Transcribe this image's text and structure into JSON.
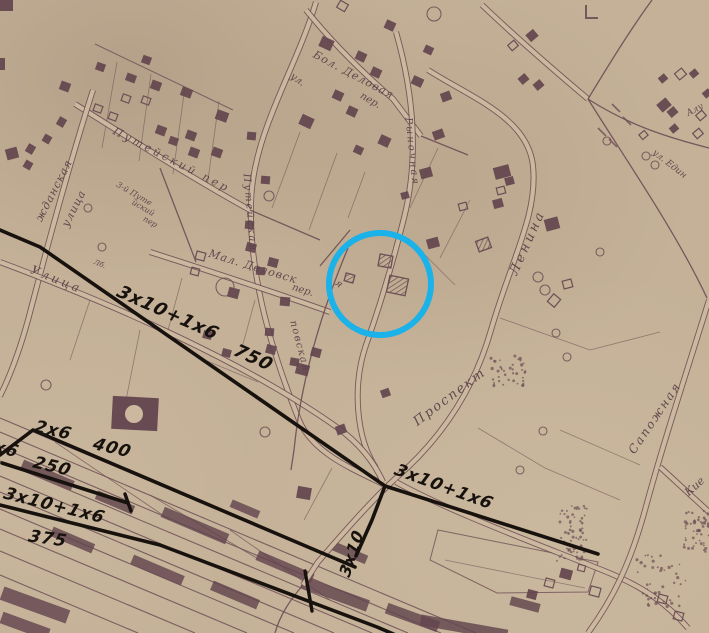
{
  "map_title": "scanned town plan with electrical line annotations",
  "colors": {
    "paper": "#c4b197",
    "paper_light": "#cbb89e",
    "ink": "#6e4e55",
    "ink_dark": "#5a3f48",
    "building": "#63454e",
    "black": "#17120e",
    "blue": "#1ab2e8"
  },
  "highlight_circle": {
    "cx": 380,
    "cy": 284,
    "r": 51,
    "stroke_width": 6
  },
  "street_labels": [
    {
      "t": "жданская",
      "x": 57,
      "y": 192,
      "r": -63,
      "s": 11,
      "sp": 1
    },
    {
      "t": "улица",
      "x": 77,
      "y": 210,
      "r": -63,
      "s": 11,
      "sp": 1
    },
    {
      "t": "Путейский пер",
      "x": 170,
      "y": 163,
      "r": 27,
      "s": 11,
      "sp": 3
    },
    {
      "t": "3-й Путе",
      "x": 133,
      "y": 196,
      "r": 30,
      "s": 8,
      "sp": 0
    },
    {
      "t": "йский",
      "x": 142,
      "y": 210,
      "r": 30,
      "s": 8,
      "sp": 0
    },
    {
      "t": "пер",
      "x": 149,
      "y": 224,
      "r": 30,
      "s": 8,
      "sp": 0
    },
    {
      "t": "Путейская",
      "x": 247,
      "y": 213,
      "r": 85,
      "s": 10,
      "sp": 2
    },
    {
      "t": "ул.",
      "x": 296,
      "y": 82,
      "r": 35,
      "s": 10,
      "sp": 0
    },
    {
      "t": "Бол. Деловая",
      "x": 352,
      "y": 78,
      "r": 28,
      "s": 11,
      "sp": 1
    },
    {
      "t": "пер.",
      "x": 369,
      "y": 103,
      "r": 30,
      "s": 10,
      "sp": 0
    },
    {
      "t": "Рыночная",
      "x": 409,
      "y": 152,
      "r": 84,
      "s": 10,
      "sp": 2
    },
    {
      "t": "Мал. Деловск",
      "x": 252,
      "y": 270,
      "r": 17,
      "s": 11,
      "sp": 1
    },
    {
      "t": "пер.",
      "x": 302,
      "y": 293,
      "r": 17,
      "s": 10,
      "sp": 0
    },
    {
      "t": "повская",
      "x": 297,
      "y": 347,
      "r": 75,
      "s": 10,
      "sp": 1.5
    },
    {
      "t": "я",
      "x": 337,
      "y": 286,
      "r": 40,
      "s": 10,
      "sp": 0
    },
    {
      "t": "Ленина",
      "x": 531,
      "y": 244,
      "r": -66,
      "s": 13,
      "sp": 3
    },
    {
      "t": "Проспект",
      "x": 452,
      "y": 400,
      "r": -37,
      "s": 13,
      "sp": 2
    },
    {
      "t": "Сапожная",
      "x": 658,
      "y": 420,
      "r": -56,
      "s": 12,
      "sp": 2
    },
    {
      "t": "Кие",
      "x": 697,
      "y": 489,
      "r": -42,
      "s": 11,
      "sp": 0
    },
    {
      "t": "Алу",
      "x": 696,
      "y": 112,
      "r": -28,
      "s": 9,
      "sp": 0
    },
    {
      "t": "ул. Един",
      "x": 668,
      "y": 166,
      "r": 38,
      "s": 9,
      "sp": 0
    },
    {
      "t": "Улица",
      "x": 55,
      "y": 283,
      "r": 22,
      "s": 12,
      "sp": 3
    },
    {
      "t": "Лб.",
      "x": 99,
      "y": 266,
      "r": 22,
      "s": 7,
      "sp": 0
    }
  ],
  "spec_annotations": [
    {
      "t": "3х10+1х6",
      "x": 197,
      "y": 332,
      "r": 24,
      "s": 18
    },
    {
      "t": "750",
      "x": 287,
      "y": 379,
      "r": 24,
      "s": 18
    },
    {
      "t": "2х6",
      "x": 97,
      "y": 446,
      "r": 13,
      "s": 17
    },
    {
      "t": "400",
      "x": 158,
      "y": 464,
      "r": 13,
      "s": 17
    },
    {
      "t": "2х6",
      "x": 46,
      "y": 464,
      "r": 13,
      "s": 17
    },
    {
      "t": "250",
      "x": 100,
      "y": 483,
      "r": 13,
      "s": 17
    },
    {
      "t": "3х10+1х6",
      "x": 106,
      "y": 524,
      "r": 14,
      "s": 17
    },
    {
      "t": "375",
      "x": 104,
      "y": 552,
      "r": 8,
      "s": 17
    },
    {
      "t": "3х10",
      "x": 373,
      "y": 505,
      "r": -72,
      "s": 16
    },
    {
      "t": "3х10+1х6",
      "x": 492,
      "y": 510,
      "r": 20,
      "s": 17
    }
  ],
  "power_lines": [
    [
      [
        0,
        230
      ],
      [
        40,
        247
      ],
      [
        385,
        486
      ]
    ],
    [
      [
        385,
        486
      ],
      [
        598,
        554
      ]
    ],
    [
      [
        385,
        486
      ],
      [
        372,
        520
      ],
      [
        356,
        556
      ]
    ],
    [
      [
        0,
        455
      ],
      [
        33,
        430
      ],
      [
        355,
        567
      ]
    ],
    [
      [
        2,
        463
      ],
      [
        128,
        503
      ]
    ],
    [
      [
        0,
        505
      ],
      [
        160,
        545
      ],
      [
        377,
        627
      ],
      [
        405,
        639
      ]
    ]
  ],
  "power_ticks": [
    [
      125,
      494,
      131,
      511
    ],
    [
      305,
      571,
      312,
      611
    ]
  ],
  "roads_double": [
    "M 428,70 C 472,98 528,118 533,166 C 538,214 512,258 491,330 C 471,400 433,446 396,478 C 372,500 344,532 318,562 L 303,585",
    "M 396,482 C 450,512 540,545 602,570 C 645,587 668,605 688,628",
    "M 709,300 C 688,368 664,440 645,510 C 630,565 612,600 588,633",
    "M 660,467 L 709,512",
    "M 316,2 C 296,70 253,132 251,202 C 249,268 267,340 299,420 C 312,452 350,468 383,484",
    "M 306,10 C 330,40 362,72 393,99 L 421,136",
    "M 396,32 C 414,95 419,158 404,218 C 394,258 382,300 366,345 C 352,386 356,438 376,468",
    "M 75,104 C 132,140 192,178 250,210",
    "M 93,90 C 70,162 49,240 28,320 C 18,356 8,380 0,396",
    "M 0,262 C 118,306 248,364 338,428 C 360,444 374,462 383,482",
    "M 482,5 C 522,43 556,72 588,99",
    "M 150,252 C 200,268 268,290 330,312"
  ],
  "roads_single": [
    "M 588,99 C 630,126 670,138 709,148",
    "M 588,99 C 626,160 676,232 707,298",
    "M 652,0 C 630,30 608,66 588,99",
    "M 160,168 L 196,262",
    "M 348,248 C 322,310 301,380 294,450 L 291,470",
    "M 421,136 L 468,155",
    "M 350,230 L 320,266",
    "M 303,585 C 290,600 280,615 275,633",
    "M 250,210 L 320,240"
  ],
  "block_outlines": [
    "M 95,44 L 233,110",
    "M 438,530 L 598,562 L 588,592 L 497,593 L 430,560 Z"
  ],
  "parcel_lines": [
    [
      117,
      62,
      102,
      148
    ],
    [
      151,
      74,
      139,
      161
    ],
    [
      185,
      87,
      173,
      174
    ],
    [
      219,
      101,
      207,
      187
    ],
    [
      300,
      132,
      272,
      208
    ],
    [
      337,
      153,
      309,
      230
    ],
    [
      365,
      172,
      348,
      218
    ],
    [
      438,
      148,
      410,
      208
    ],
    [
      470,
      200,
      440,
      258
    ],
    [
      182,
      278,
      168,
      330
    ],
    [
      255,
      300,
      240,
      355
    ],
    [
      200,
      358,
      258,
      382
    ],
    [
      140,
      330,
      122,
      420
    ],
    [
      90,
      300,
      70,
      360
    ],
    [
      478,
      428,
      545,
      468
    ],
    [
      545,
      468,
      620,
      500
    ],
    [
      332,
      468,
      304,
      520
    ],
    [
      445,
      560,
      585,
      588
    ],
    [
      500,
      318,
      590,
      350
    ],
    [
      590,
      350,
      660,
      332
    ],
    [
      560,
      430,
      640,
      465
    ],
    [
      420,
      250,
      455,
      285
    ]
  ],
  "railway": {
    "tracks": [
      [
        0,
        418,
        300,
        544
      ],
      [
        0,
        432,
        476,
        633
      ],
      [
        0,
        447,
        441,
        633
      ],
      [
        0,
        461,
        408,
        633
      ],
      [
        0,
        476,
        372,
        633
      ],
      [
        0,
        492,
        334,
        633
      ],
      [
        0,
        509,
        294,
        633
      ],
      [
        0,
        529,
        247,
        633
      ],
      [
        0,
        551,
        195,
        633
      ],
      [
        0,
        575,
        138,
        633
      ]
    ],
    "connectors": [
      [
        55,
        442,
        170,
        520
      ],
      [
        150,
        495,
        260,
        560
      ],
      [
        230,
        530,
        330,
        600
      ]
    ],
    "cars": [
      [
        20,
        470,
        55,
        10,
        23
      ],
      [
        95,
        498,
        40,
        9,
        23
      ],
      [
        160,
        520,
        70,
        11,
        23
      ],
      [
        255,
        562,
        60,
        10,
        23
      ],
      [
        50,
        535,
        45,
        10,
        23
      ],
      [
        130,
        565,
        55,
        10,
        23
      ],
      [
        210,
        590,
        50,
        10,
        23
      ],
      [
        300,
        588,
        70,
        12,
        20
      ],
      [
        385,
        612,
        55,
        11,
        20
      ],
      [
        330,
        548,
        38,
        9,
        23
      ],
      [
        420,
        622,
        88,
        11,
        10
      ],
      [
        0,
        598,
        70,
        14,
        20
      ],
      [
        0,
        620,
        50,
        12,
        20
      ],
      [
        230,
        505,
        30,
        8,
        23
      ],
      [
        510,
        600,
        30,
        9,
        15
      ]
    ]
  },
  "station": {
    "x": 112,
    "y": 397,
    "w": 46,
    "h": 33,
    "r": 3,
    "circle": [
      134,
      414,
      9
    ]
  },
  "buildings": [
    [
      0,
      0,
      13,
      11,
      0,
      "f"
    ],
    [
      0,
      58,
      5,
      12,
      0,
      "f"
    ],
    [
      6,
      148,
      12,
      11,
      -15,
      "f"
    ],
    [
      60,
      82,
      10,
      9,
      20,
      "f"
    ],
    [
      96,
      63,
      9,
      8,
      20,
      "f"
    ],
    [
      126,
      74,
      10,
      8,
      20,
      "f"
    ],
    [
      142,
      56,
      9,
      8,
      20,
      "f"
    ],
    [
      151,
      81,
      10,
      9,
      20,
      "f"
    ],
    [
      181,
      88,
      11,
      9,
      20,
      "f"
    ],
    [
      216,
      111,
      12,
      10,
      20,
      "f"
    ],
    [
      122,
      95,
      8,
      7,
      20,
      "o"
    ],
    [
      142,
      97,
      8,
      7,
      20,
      "o"
    ],
    [
      94,
      105,
      8,
      7,
      20,
      "o"
    ],
    [
      109,
      113,
      8,
      7,
      20,
      "o"
    ],
    [
      156,
      126,
      10,
      9,
      20,
      "f"
    ],
    [
      169,
      137,
      9,
      8,
      20,
      "f"
    ],
    [
      186,
      131,
      10,
      9,
      20,
      "f"
    ],
    [
      189,
      148,
      10,
      9,
      20,
      "f"
    ],
    [
      212,
      148,
      10,
      9,
      20,
      "f"
    ],
    [
      57,
      118,
      9,
      8,
      -60,
      "f"
    ],
    [
      43,
      135,
      8,
      8,
      -60,
      "f"
    ],
    [
      26,
      145,
      9,
      8,
      -60,
      "f"
    ],
    [
      24,
      161,
      8,
      8,
      -60,
      "f"
    ],
    [
      247,
      132,
      9,
      8,
      5,
      "f"
    ],
    [
      261,
      176,
      9,
      8,
      5,
      "f"
    ],
    [
      245,
      221,
      9,
      8,
      5,
      "f"
    ],
    [
      256,
      267,
      9,
      8,
      5,
      "f"
    ],
    [
      280,
      297,
      10,
      9,
      5,
      "f"
    ],
    [
      265,
      328,
      9,
      8,
      5,
      "f"
    ],
    [
      290,
      358,
      9,
      8,
      10,
      "f"
    ],
    [
      338,
      2,
      9,
      8,
      30,
      "o"
    ],
    [
      320,
      38,
      13,
      11,
      25,
      "f"
    ],
    [
      356,
      52,
      10,
      9,
      25,
      "f"
    ],
    [
      371,
      68,
      10,
      9,
      25,
      "f"
    ],
    [
      333,
      91,
      10,
      9,
      25,
      "f"
    ],
    [
      347,
      107,
      10,
      9,
      25,
      "f"
    ],
    [
      300,
      116,
      13,
      11,
      25,
      "f"
    ],
    [
      379,
      136,
      11,
      10,
      25,
      "f"
    ],
    [
      354,
      146,
      9,
      8,
      25,
      "f"
    ],
    [
      412,
      77,
      11,
      9,
      25,
      "f"
    ],
    [
      424,
      46,
      9,
      8,
      25,
      "f"
    ],
    [
      385,
      21,
      10,
      9,
      25,
      "f"
    ],
    [
      441,
      92,
      10,
      9,
      -20,
      "f"
    ],
    [
      433,
      130,
      11,
      9,
      -20,
      "f"
    ],
    [
      420,
      168,
      12,
      10,
      -15,
      "f"
    ],
    [
      401,
      192,
      8,
      7,
      -15,
      "f"
    ],
    [
      196,
      252,
      9,
      8,
      15,
      "o"
    ],
    [
      191,
      268,
      8,
      7,
      15,
      "o"
    ],
    [
      246,
      243,
      10,
      9,
      15,
      "f"
    ],
    [
      268,
      258,
      10,
      9,
      15,
      "f"
    ],
    [
      228,
      288,
      11,
      10,
      15,
      "f"
    ],
    [
      203,
      331,
      9,
      8,
      15,
      "f"
    ],
    [
      222,
      349,
      9,
      8,
      15,
      "f"
    ],
    [
      266,
      345,
      10,
      9,
      15,
      "f"
    ],
    [
      296,
      364,
      13,
      11,
      15,
      "f"
    ],
    [
      311,
      348,
      10,
      9,
      15,
      "f"
    ],
    [
      379,
      255,
      13,
      12,
      10,
      "h"
    ],
    [
      388,
      277,
      19,
      17,
      12,
      "h"
    ],
    [
      345,
      274,
      9,
      8,
      15,
      "h"
    ],
    [
      427,
      238,
      12,
      10,
      -15,
      "f"
    ],
    [
      477,
      239,
      13,
      11,
      -20,
      "h"
    ],
    [
      459,
      203,
      8,
      7,
      -15,
      "o"
    ],
    [
      494,
      166,
      16,
      12,
      -15,
      "f"
    ],
    [
      505,
      177,
      9,
      8,
      -15,
      "f"
    ],
    [
      497,
      187,
      8,
      7,
      -15,
      "o"
    ],
    [
      493,
      199,
      10,
      9,
      -15,
      "f"
    ],
    [
      545,
      218,
      14,
      12,
      -15,
      "f"
    ],
    [
      563,
      280,
      9,
      8,
      -15,
      "o"
    ],
    [
      527,
      31,
      10,
      9,
      -40,
      "f"
    ],
    [
      509,
      42,
      8,
      7,
      -40,
      "o"
    ],
    [
      519,
      75,
      9,
      8,
      -40,
      "f"
    ],
    [
      534,
      81,
      9,
      8,
      -40,
      "f"
    ],
    [
      658,
      100,
      12,
      10,
      -40,
      "f"
    ],
    [
      668,
      108,
      9,
      8,
      -40,
      "f"
    ],
    [
      670,
      125,
      8,
      7,
      -40,
      "f"
    ],
    [
      694,
      130,
      8,
      7,
      -40,
      "o"
    ],
    [
      697,
      112,
      8,
      7,
      -40,
      "o"
    ],
    [
      676,
      70,
      9,
      8,
      -40,
      "o"
    ],
    [
      659,
      75,
      8,
      7,
      -40,
      "f"
    ],
    [
      690,
      70,
      8,
      7,
      -40,
      "f"
    ],
    [
      703,
      90,
      8,
      7,
      -40,
      "f"
    ],
    [
      640,
      132,
      7,
      6,
      -40,
      "o"
    ],
    [
      549,
      296,
      10,
      9,
      -50,
      "o"
    ],
    [
      560,
      569,
      12,
      10,
      15,
      "f"
    ],
    [
      545,
      579,
      9,
      8,
      15,
      "o"
    ],
    [
      527,
      590,
      10,
      9,
      15,
      "f"
    ],
    [
      590,
      587,
      10,
      9,
      15,
      "o"
    ],
    [
      658,
      595,
      9,
      8,
      15,
      "o"
    ],
    [
      674,
      612,
      9,
      8,
      15,
      "o"
    ],
    [
      578,
      565,
      7,
      6,
      15,
      "o"
    ],
    [
      297,
      487,
      14,
      12,
      10,
      "f"
    ],
    [
      381,
      389,
      9,
      8,
      -20,
      "f"
    ],
    [
      336,
      425,
      10,
      9,
      -20,
      "f"
    ]
  ],
  "tree_circles": [
    [
      46,
      385,
      5
    ],
    [
      225,
      287,
      9
    ],
    [
      269,
      196,
      5
    ],
    [
      434,
      14,
      7
    ],
    [
      538,
      277,
      5
    ],
    [
      545,
      290,
      5
    ],
    [
      607,
      141,
      4
    ],
    [
      646,
      156,
      4
    ],
    [
      655,
      165,
      4
    ],
    [
      556,
      333,
      4
    ],
    [
      600,
      252,
      4
    ],
    [
      520,
      470,
      4
    ],
    [
      543,
      431,
      4
    ],
    [
      567,
      357,
      4
    ],
    [
      88,
      208,
      4
    ],
    [
      102,
      247,
      4
    ],
    [
      265,
      432,
      5
    ]
  ],
  "stipple_areas": [
    [
      556,
      505,
      588,
      562,
      60
    ],
    [
      684,
      510,
      709,
      552,
      50
    ],
    [
      636,
      552,
      686,
      608,
      45
    ],
    [
      488,
      356,
      526,
      386,
      40
    ]
  ],
  "hatch_marks": [
    [
      612,
      104,
      620,
      112
    ],
    [
      623,
      117,
      631,
      125
    ],
    [
      598,
      128,
      606,
      136
    ],
    [
      609,
      139,
      617,
      147
    ]
  ],
  "corner_mark_path": "M 586,5 L 586,18 L 598,18"
}
